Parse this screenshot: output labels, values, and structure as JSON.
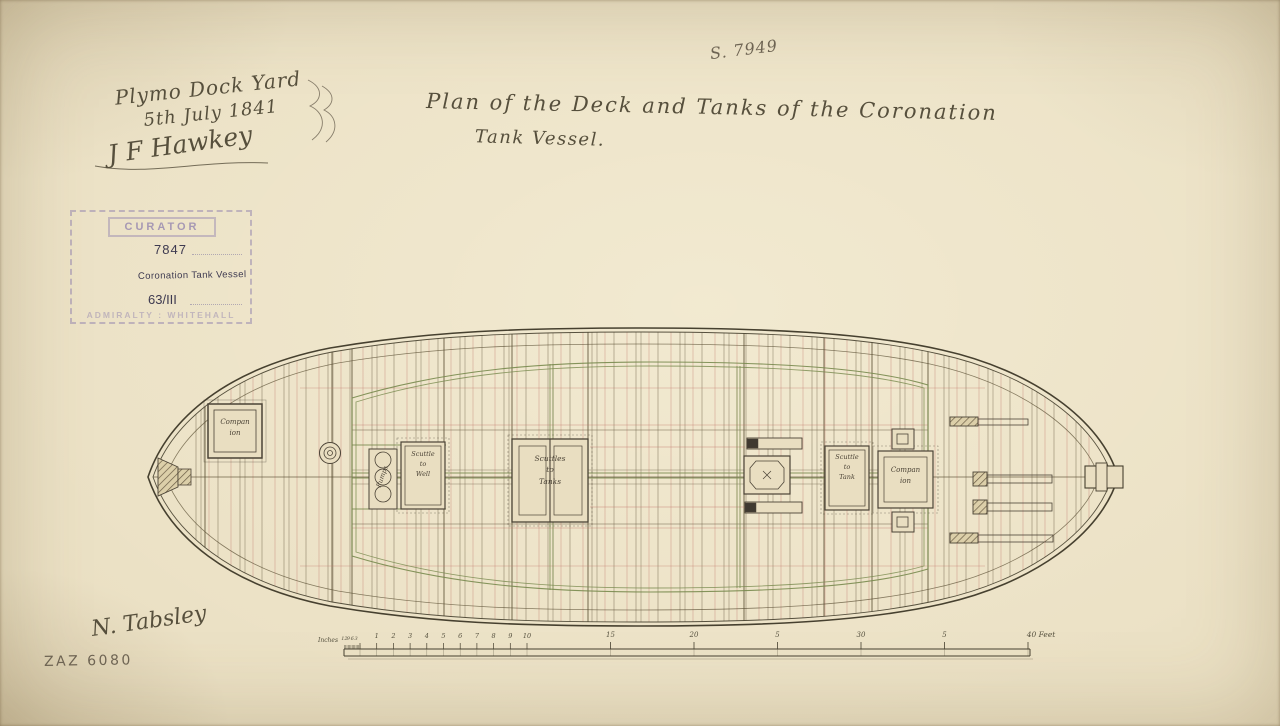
{
  "colors": {
    "paper": "#e9dec1",
    "ink": "#4b4336",
    "line_sepia": "#6e6148",
    "line_red": "#bf7468",
    "line_green": "#78894e",
    "pencil": "#6e6453",
    "stamp_purple": "#8074aa"
  },
  "annotations": {
    "survey_number": "S. 7949",
    "yard": {
      "line1": "Plymo Dock Yard",
      "line2": "5th July 1841",
      "signature": "J F Hawkey"
    },
    "title_line1": "Plan of the Deck and Tanks of the Coronation",
    "title_line2": "Tank Vessel.",
    "surveyor_signature": "N. Tabsley",
    "archive_reference": "ZAZ 6080"
  },
  "stamp": {
    "header": "CURATOR",
    "number": "7847",
    "vessel": "Coronation Tank Vessel",
    "box_reference": "63/III",
    "footer": "ADMIRALTY : WHITEHALL"
  },
  "deck_labels": {
    "companion_aft": [
      "Compan",
      "ion"
    ],
    "pumps": "Pumps",
    "scuttle_to_well": [
      "Scuttle",
      "to",
      "Well"
    ],
    "scuttles_to_tanks": [
      "Scuttles",
      "to",
      "Tanks"
    ],
    "scuttle_to_tank": [
      "Scuttle",
      "to",
      "Tank"
    ],
    "companion_fore": [
      "Compan",
      "ion"
    ]
  },
  "scale_bar": {
    "inches_label": "Inches",
    "inch_labels": [
      "12",
      "9",
      "6",
      "3"
    ],
    "foot_labels": [
      "1",
      "2",
      "3",
      "4",
      "5",
      "6",
      "7",
      "8",
      "9",
      "10"
    ],
    "major_labels": [
      "15",
      "20",
      "5",
      "30",
      "5"
    ],
    "end_label": "40 Feet"
  }
}
